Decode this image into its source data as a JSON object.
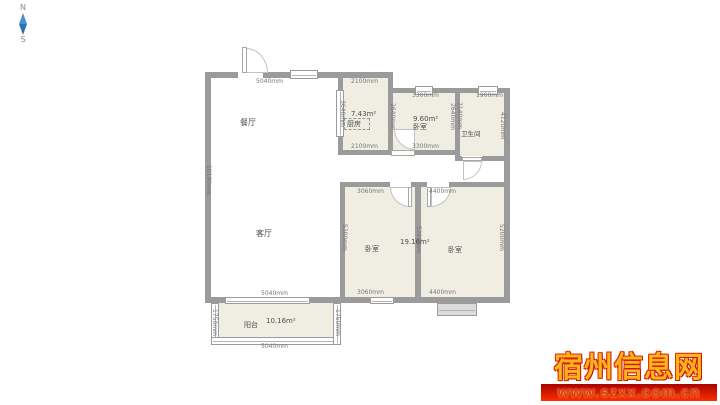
{
  "compass": {
    "north": "N",
    "south": "S"
  },
  "rooms": {
    "dining": {
      "name": "餐厅"
    },
    "living": {
      "name": "客厅"
    },
    "kitchen": {
      "name": "厨房",
      "area": "7.43m²"
    },
    "bedroom_top": {
      "name": "卧室",
      "area": "9.60m²"
    },
    "bathroom": {
      "name": "卫生间"
    },
    "bedroom_left": {
      "name": "卧室"
    },
    "bedroom_right": {
      "name": "卧室",
      "area": "19.16m²"
    },
    "balcony": {
      "name": "阳台",
      "area": "10.16m²"
    }
  },
  "dims": {
    "dining_top": "5040mm",
    "kitchen_top": "2100mm",
    "kitchen_bottom": "2100mm",
    "kitchen_height": "3640mm",
    "bedroom2_top": "3300mm",
    "bedroom2_bottom": "3300mm",
    "bedroom2_left_height": "2640mm",
    "bedroom2_right_height": "2640mm",
    "bathroom_top": "1900mm",
    "bathroom_left_height": "2140mm",
    "bathroom_right_height": "4120mm",
    "living_height": "10190mm",
    "bedroom3_top": "3060mm",
    "bedroom3_bottom": "3060mm",
    "bedroom3_height": "5200mm",
    "center_wall_height": "5200mm",
    "bedroom1_top": "4400mm",
    "bedroom1_bottom": "4400mm",
    "bedroom1_height": "5200mm",
    "balcony_top": "5040mm",
    "balcony_bottom": "5040mm",
    "balcony_left_height": "1750mm",
    "balcony_right_height": "1750mm"
  },
  "watermark": {
    "site_name": "宿州信息网",
    "site_url": "www.szxx.com.cn"
  },
  "colors": {
    "wall_gray": "#9b9b9b",
    "room_beige": "#f0ede3",
    "compass_blue": "#4a8fd0",
    "watermark_red": "#d42000",
    "watermark_gold": "#ffb41e"
  }
}
